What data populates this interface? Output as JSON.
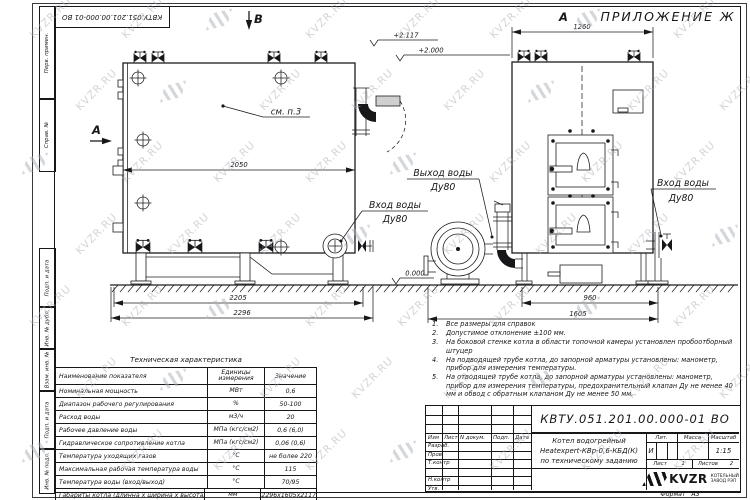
{
  "sheet": {
    "appendix_label": "ПРИЛОЖЕНИЕ Ж",
    "format_label": "Формат",
    "format_value": "А3"
  },
  "watermark": {
    "text": "KVZR.RU"
  },
  "margin_labels": [
    "Перв. примен.",
    "Справ. №",
    "Подп. и дата",
    "Инв. № дубл.",
    "Взам. инв. №",
    "Подп. и дата",
    "Инв. № подл."
  ],
  "drawing": {
    "view_labels": {
      "a_left": "А",
      "a_top": "А",
      "b_top": "В"
    },
    "callouts": {
      "see_note": "см. п.3",
      "outlet_line1": "Выход воды",
      "outlet_line2": "Ду80",
      "inlet_left_line1": "Вход воды",
      "inlet_left_line2": "Ду80",
      "inlet_right_line1": "Вход воды",
      "inlet_right_line2": "Ду80"
    },
    "elevations": {
      "top1": "+2.117",
      "top2": "+2.000",
      "ground": "0.000"
    },
    "dimensions": {
      "body_length": "2050",
      "base_length": "2205",
      "overall_length": "2296",
      "front_width": "1260",
      "base_depth": "960",
      "overall_depth": "1605"
    }
  },
  "notes": {
    "items": [
      {
        "num": "1.",
        "text": "Все размеры для справок"
      },
      {
        "num": "2.",
        "text": "Допустимое отклонение ±100 мм."
      },
      {
        "num": "3.",
        "text": "На боковой стенке котла в области топочной камеры установлен пробоотборный штуцер"
      },
      {
        "num": "4.",
        "text": "На подводящей трубе котла, до запорной арматуры установлены: манометр, прибор для измерения температуры."
      },
      {
        "num": "5.",
        "text": "На отводящей трубе котла, до запорной арматуры установлены: манометр, прибор для измерения температуры, предохранительный клапан Ду не менее 40 мм и обвод с обратным клапаном Ду не менее 50 мм."
      }
    ]
  },
  "spec_table": {
    "title": "Техническая характеристика",
    "headers": [
      "Наименование показателя",
      "Единицы измерения",
      "Значение"
    ],
    "rows": [
      {
        "name": "Номинальная мощность",
        "unit": "МВт",
        "value": "0,6"
      },
      {
        "name": "Диапазон рабочего регулирования",
        "unit": "%",
        "value": "50-100"
      },
      {
        "name": "Расход воды",
        "unit": "м3/ч",
        "value": "20"
      },
      {
        "name": "Рабочее давление воды",
        "unit": "МПа (кгс/см2)",
        "value": "0,6 (6,0)"
      },
      {
        "name": "Гидравлическое сопротивление котла",
        "unit": "МПа (кгс/см2)",
        "value": "0,06 (0,6)"
      },
      {
        "name": "Температура уходящих газов",
        "unit": "°С",
        "value": "не более 220"
      },
      {
        "name": "Максимальная рабочая температура воды",
        "unit": "°С",
        "value": "115"
      },
      {
        "name": "Температура воды (вход/выход)",
        "unit": "°С",
        "value": "70/95"
      },
      {
        "name": "Габариты котла (длинна х ширина х высота)",
        "unit": "мм",
        "value": "2296х1605х2117"
      }
    ]
  },
  "title_block": {
    "doc_number": "КВТУ.051.201.00.000-01 ВО",
    "rev_headers": [
      "Изм",
      "Лист",
      "N докум.",
      "Подп.",
      "Дата"
    ],
    "role_rows": [
      "Разраб.",
      "Пров.",
      "Т.контр",
      "",
      "Н.контр",
      "Утв."
    ],
    "product_name_lines": [
      "Котел водогрейный",
      "Heatexpert-КВр-0,6-КБД(К)",
      "по техническому заданию"
    ],
    "lit_header": "Лит.",
    "lit_value": "И",
    "mass_header": "Масса",
    "mass_value": "",
    "scale_header": "Масштаб",
    "scale_value": "1:15",
    "sheet_label": "Лист",
    "sheet_value": "1",
    "sheets_label": "Листов",
    "sheets_value": "2",
    "company": {
      "logo_text": "KVZR",
      "tagline_line1": "КОТЕЛЬНЫЙ",
      "tagline_line2": "ЗАВОД РЭП"
    }
  }
}
